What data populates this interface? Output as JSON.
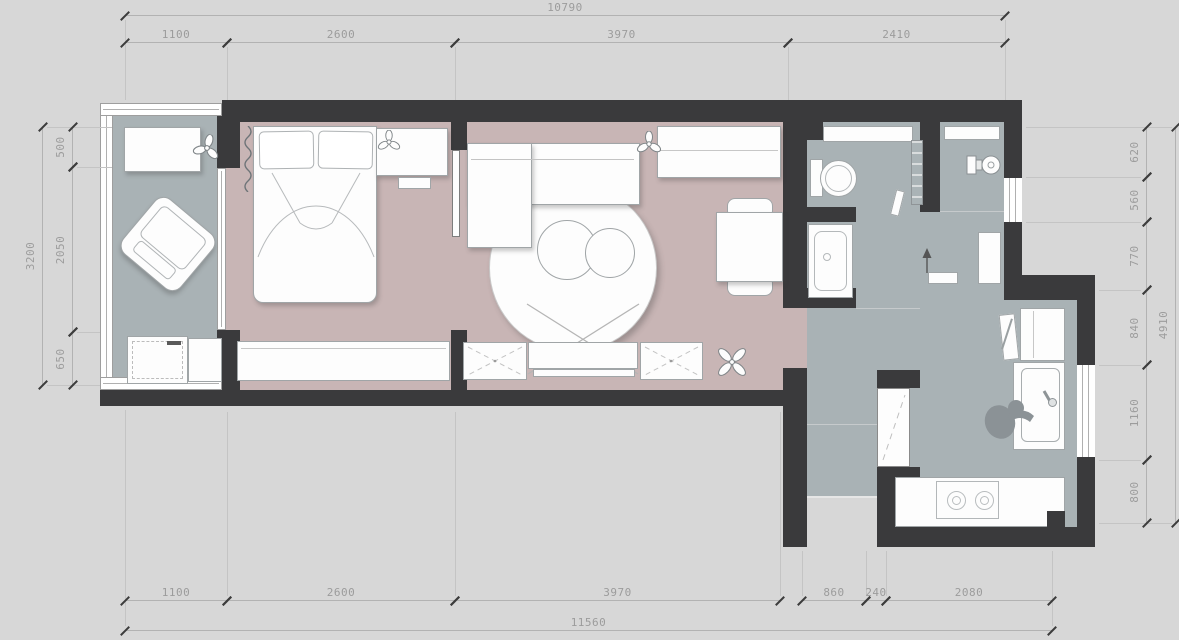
{
  "document": {
    "type": "residential floor plan"
  },
  "dims": {
    "top": {
      "overall": "10790",
      "segments": [
        "1100",
        "2600",
        "3970",
        "2410"
      ]
    },
    "bottom": {
      "overall": "11560",
      "segments": [
        "1100",
        "2600",
        "3970",
        "860",
        "240",
        "2080"
      ]
    },
    "left": {
      "overall": "3200",
      "segments": [
        "500",
        "2050",
        "650"
      ]
    },
    "right": {
      "overall": "4910",
      "segments": [
        "620",
        "560",
        "770",
        "840",
        "1160",
        "800"
      ]
    }
  },
  "colors": {
    "background": "#d7d7d7",
    "wall": "#3a3a3c",
    "floor_warm": "#c8b5b5",
    "floor_cool": "#a9b2b5",
    "furniture": "#fdfdfd",
    "dimension_text": "#9c9c9c"
  },
  "rooms": [
    "balcony",
    "bedroom",
    "living-room",
    "dining-area",
    "bathroom",
    "entry",
    "hallway",
    "kitchen"
  ],
  "furniture_icons": [
    "double-bed",
    "pillows",
    "curtain-squiggle",
    "nightstand",
    "potted-plant",
    "wardrobe",
    "tv-cabinet",
    "tv-screen-x",
    "l-shaped-sofa",
    "round-rug",
    "coffee-tables",
    "dining-table",
    "dining-chair",
    "armchair",
    "side-table",
    "washing-machine",
    "toilet",
    "bathtub",
    "towel-radiator",
    "towel",
    "washbasin",
    "entry-door",
    "storage-cabinet",
    "wall-shelf",
    "north-arrow",
    "fridge",
    "cutting-board-knife",
    "kitchen-sink",
    "faucet",
    "cooktop-two-burners",
    "person-figure",
    "window",
    "sliding-door",
    "door-leaf"
  ]
}
